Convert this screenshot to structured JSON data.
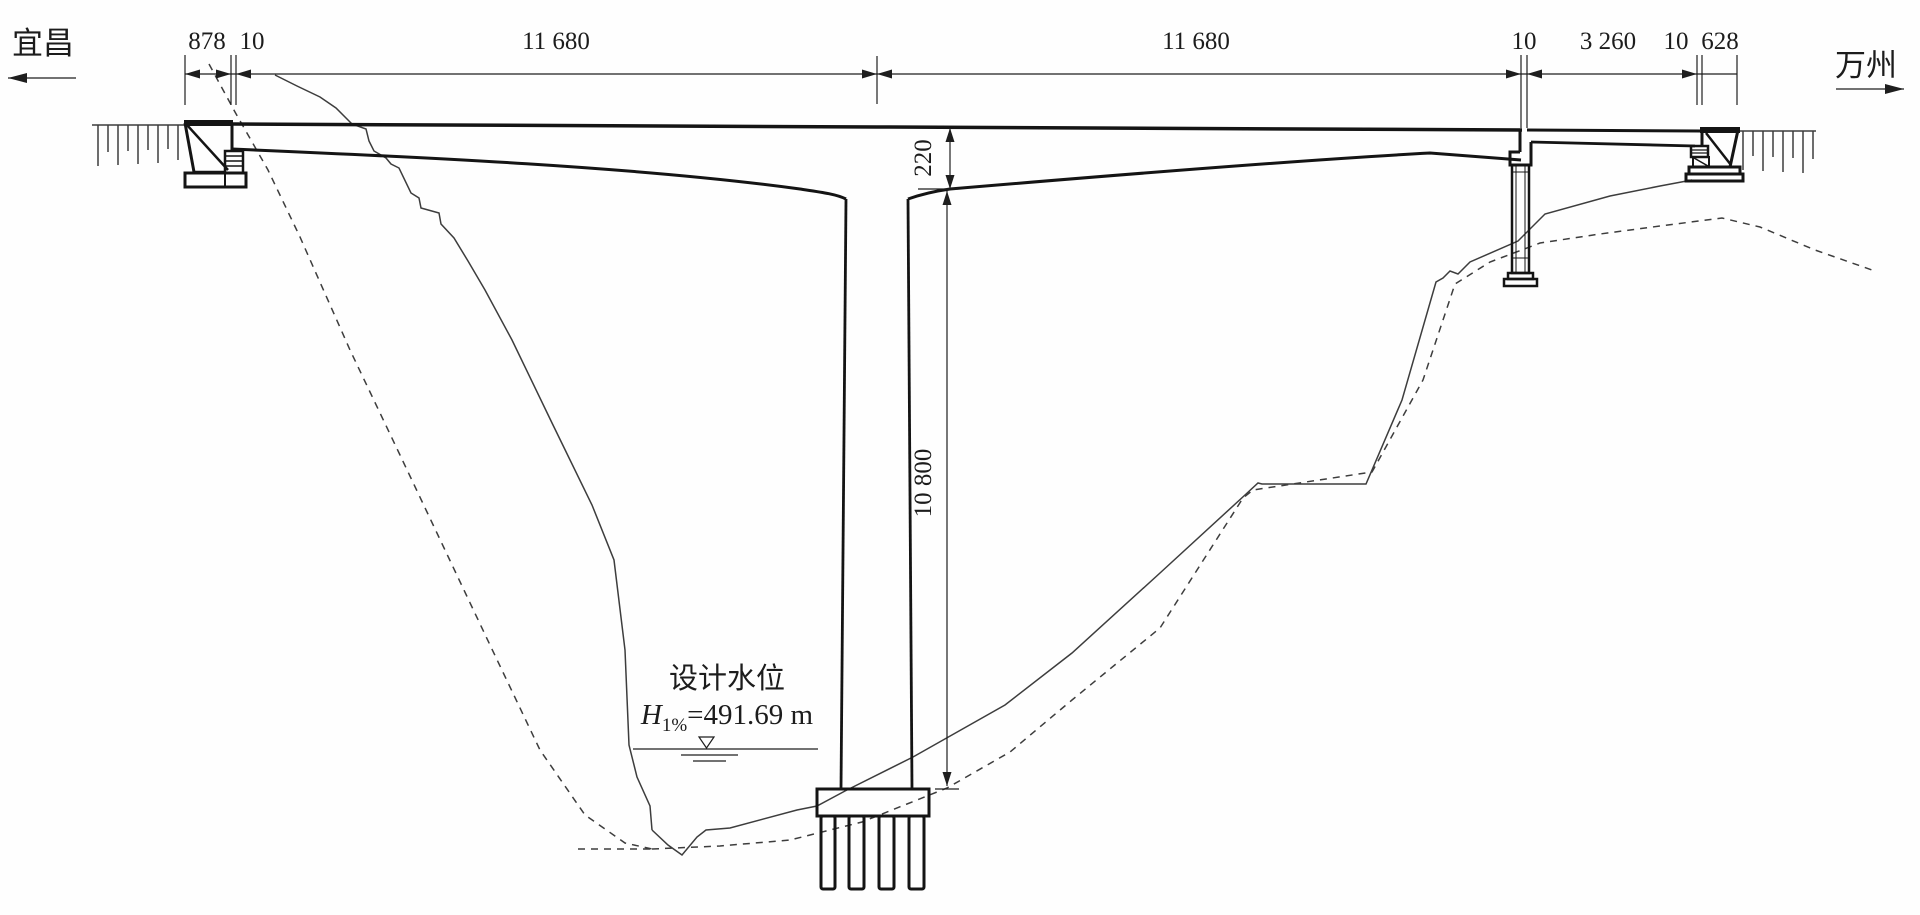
{
  "directions": {
    "left": "宜昌",
    "right": "万州"
  },
  "dims": {
    "left_overhang": "878",
    "left_joint_gap": "10",
    "left_span": "11 680",
    "right_span": "11 680",
    "right_joint_gap": "10",
    "approach_span": "3 260",
    "abutment_gap": "10",
    "right_overhang": "628",
    "girder_depth_at_pier": "220",
    "pier_height": "10 800"
  },
  "water_level": {
    "label": "设计水位",
    "symbol": "H",
    "subscript": "1%",
    "value": "=491.69 m"
  }
}
